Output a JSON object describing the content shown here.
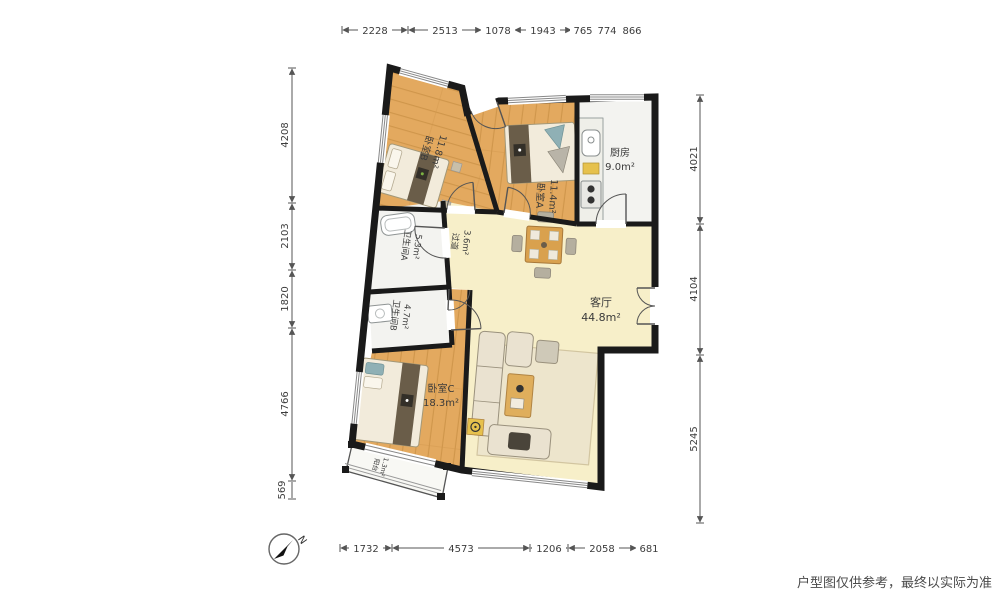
{
  "meta": {
    "title": "户型图",
    "disclaimer": "户型图仅供参考，最终以实际为准",
    "compass_label": "N"
  },
  "rooms": [
    {
      "id": "bedroomB",
      "name": "卧室B",
      "area": "11.8m²"
    },
    {
      "id": "bedroomA",
      "name": "卧室A",
      "area": "11.4m²"
    },
    {
      "id": "kitchen",
      "name": "厨房",
      "area": "9.0m²"
    },
    {
      "id": "hallway",
      "name": "过道",
      "area": "3.6m²"
    },
    {
      "id": "bathroomA",
      "name": "卫生间A",
      "area": "5.3m²"
    },
    {
      "id": "bathroomB",
      "name": "卫生间B",
      "area": "4.7m²"
    },
    {
      "id": "livingroom",
      "name": "客厅",
      "area": "44.8m²"
    },
    {
      "id": "bedroomC",
      "name": "卧室C",
      "area": "18.3m²"
    },
    {
      "id": "balcony",
      "name": "阳台",
      "area": "1.3m²"
    }
  ],
  "dimensions": {
    "top": [
      "2228",
      "2513",
      "1078",
      "1943",
      "765",
      "774",
      "866"
    ],
    "bottom": [
      "1732",
      "4573",
      "1206",
      "2058",
      "681"
    ],
    "left": [
      "4208",
      "2103",
      "1820",
      "4766",
      "569"
    ],
    "right": [
      "4021",
      "4104",
      "5245"
    ]
  },
  "colors": {
    "wall": "#1a1a1a",
    "wood_floor": "#e3a95f",
    "living_floor": "#f7efc9",
    "tile_floor": "#f3f3f0",
    "dim_text": "#3c3c3c"
  }
}
